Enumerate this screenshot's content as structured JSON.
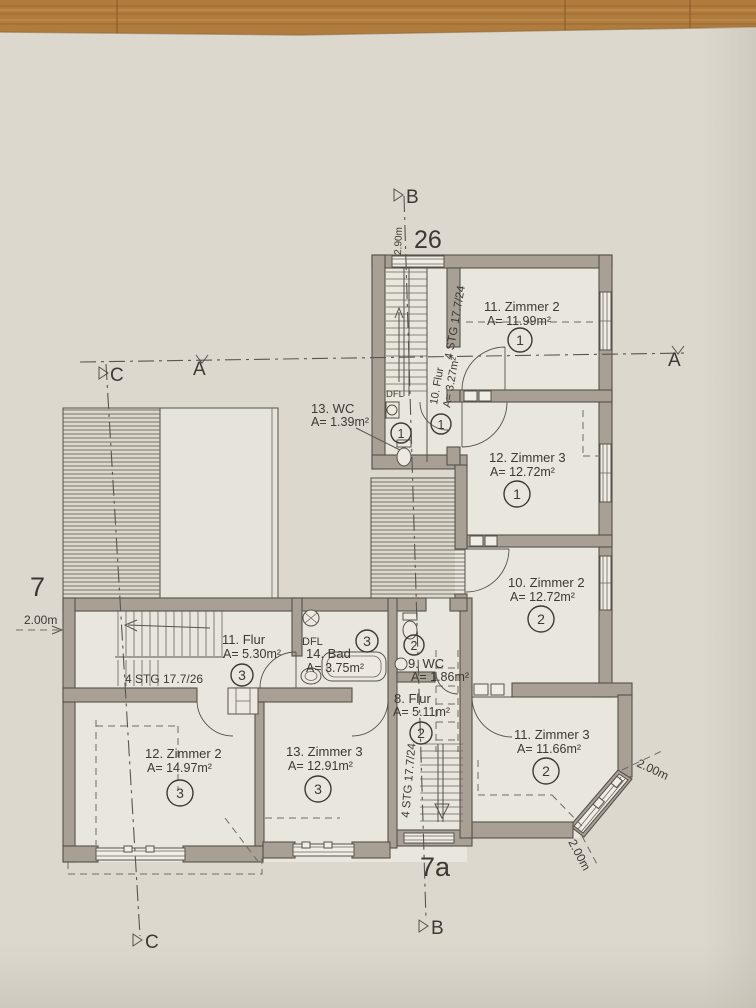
{
  "drawing": {
    "type": "architectural-floor-plan",
    "house_numbers": {
      "left": "7",
      "top": "26",
      "bottom": "7a"
    },
    "section_markers": {
      "a_left": "A",
      "a_right": "A",
      "b_top": "B",
      "b_bottom": "B",
      "c_top": "C",
      "c_bottom": "C"
    },
    "dimensions": {
      "top_vertical": "2.90m",
      "left": "2.00m",
      "bay_upper": "2.00m",
      "bay_lower": "2.00m"
    },
    "stairs": {
      "top": "4 STG 17.7/24",
      "middle": "4 STG 17.7/26",
      "bottom": "4 STG 17.7/24"
    },
    "labels": {
      "dfl_top": "DFL",
      "dfl_mid": "DFL"
    },
    "rooms": [
      {
        "name": "11. Zimmer 2",
        "area": "A= 11.99m²",
        "unit": "1"
      },
      {
        "name": "12. Zimmer 3",
        "area": "A= 12.72m²",
        "unit": "1"
      },
      {
        "name": "10. Zimmer 2",
        "area": "A= 12.72m²",
        "unit": "2"
      },
      {
        "name": "11. Zimmer 3",
        "area": "A= 11.66m²",
        "unit": "2"
      },
      {
        "name": "13. WC",
        "area": "A= 1.39m²",
        "unit": "1"
      },
      {
        "name": "10. Flur",
        "area": "A= 3.27m²",
        "unit": "1"
      },
      {
        "name": "11. Flur",
        "area": "A= 5.30m²",
        "unit": "3"
      },
      {
        "name": "14. Bad",
        "area": "A= 3.75m²",
        "unit": "3"
      },
      {
        "name": "9. WC",
        "area": "A= 1.86m²",
        "unit": "2"
      },
      {
        "name": "8. Flur",
        "area": "A= 5.11m²",
        "unit": "2"
      },
      {
        "name": "12. Zimmer 2",
        "area": "A= 14.97m²",
        "unit": "3"
      },
      {
        "name": "13. Zimmer 3",
        "area": "A= 12.91m²",
        "unit": "3"
      }
    ],
    "colors": {
      "paper": "#dcd8ce",
      "room_fill": "#e9e6dd",
      "wall_fill": "#a8a094",
      "line": "#56524b",
      "wood_table": "#b07c3e"
    }
  }
}
